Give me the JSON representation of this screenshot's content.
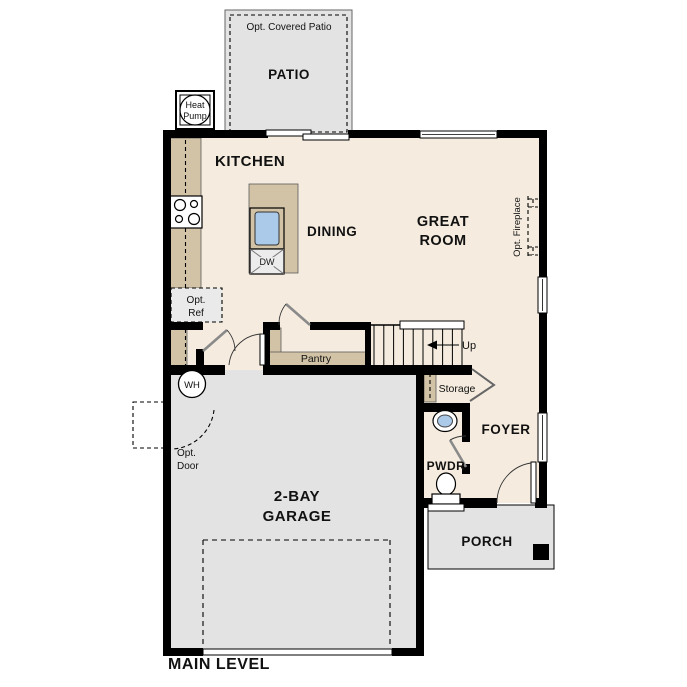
{
  "plan": {
    "level_label": "MAIN LEVEL",
    "labels": {
      "opt_covered_patio": "Opt. Covered Patio",
      "patio": "PATIO",
      "heat_pump": [
        "Heat",
        "Pump"
      ],
      "kitchen": "KITCHEN",
      "dining": "DINING",
      "great_room": [
        "GREAT",
        "ROOM"
      ],
      "opt_fireplace": "Opt. Fireplace",
      "opt_ref": [
        "Opt.",
        "Ref"
      ],
      "dw": "DW",
      "pantry": "Pantry",
      "up": "Up",
      "wh": "WH",
      "storage": "Storage",
      "opt_door": [
        "Opt.",
        "Door"
      ],
      "garage": [
        "2-BAY",
        "GARAGE"
      ],
      "foyer": "FOYER",
      "pwdr": "PWDR",
      "porch": "PORCH"
    },
    "colors": {
      "floor": "#f5ecdf",
      "garage_floor": "#e3e3e3",
      "patio_floor": "#e3e3e3",
      "porch_floor": "#e3e3e3",
      "counter": "#d2c3a6",
      "optional_fill": "#eaeaea",
      "sink": "#abc9e9",
      "wall": "#000000",
      "door": "#8a8a8a"
    }
  }
}
